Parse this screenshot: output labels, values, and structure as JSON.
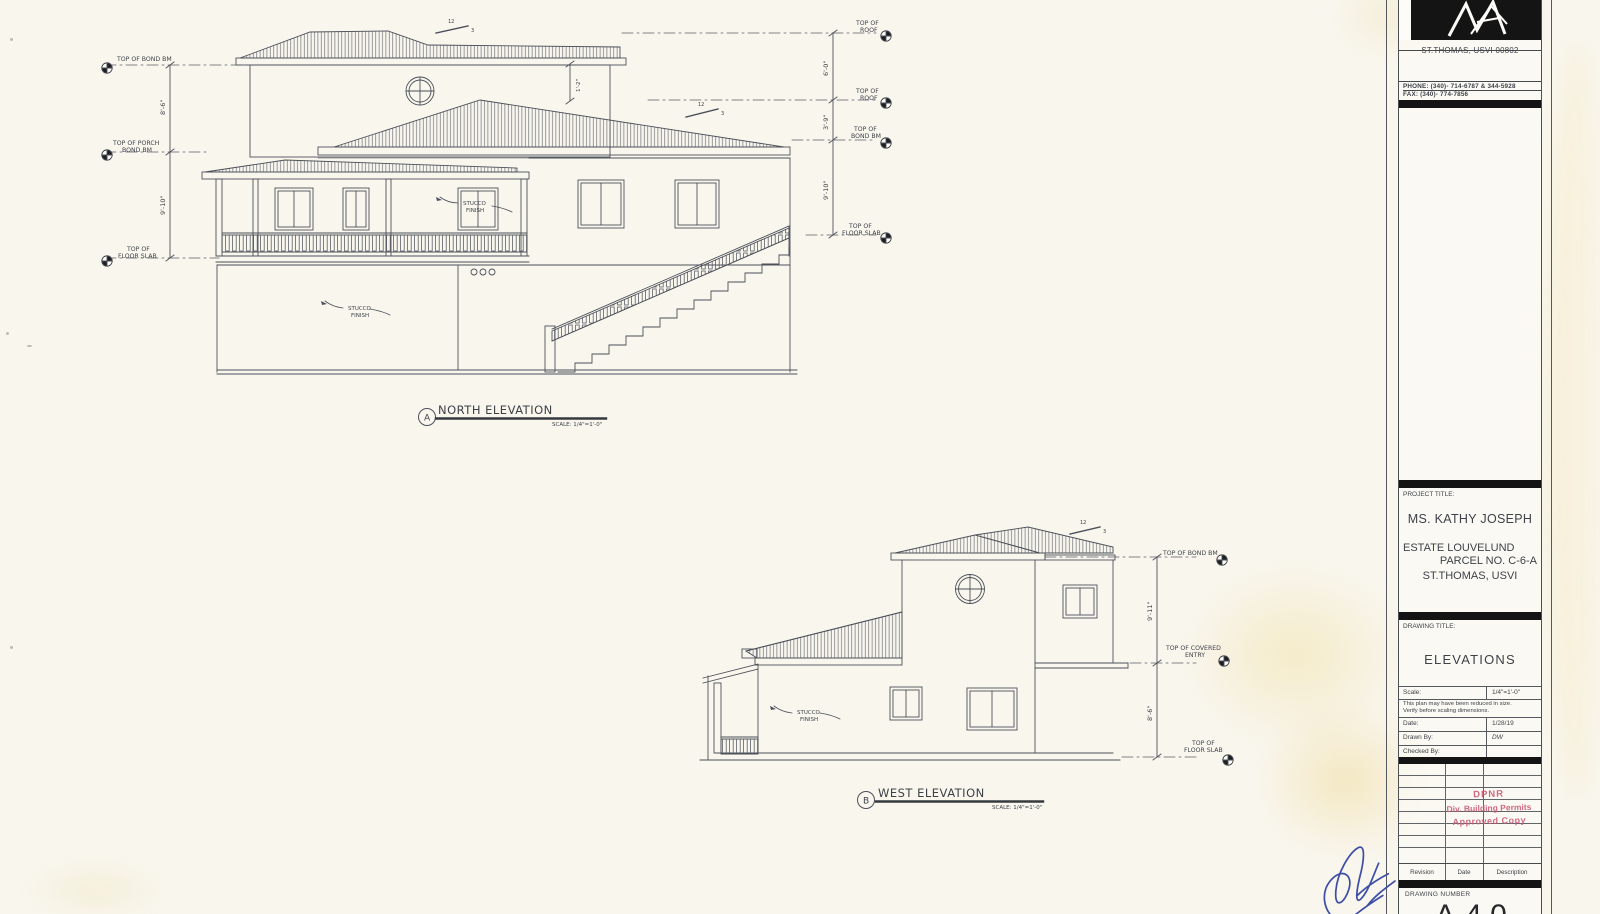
{
  "common": {
    "stucco_line1": "STUCCO",
    "stucco_line2": "FINISH"
  },
  "north": {
    "tag": "A",
    "title": "NORTH ELEVATION",
    "scale_note": "SCALE: 1/4\"=1'-0\"",
    "labels": {
      "left1": "TOP OF BOND BM",
      "left2a": "TOP OF PORCH",
      "left2b": "BOND BM",
      "left3a": "TOP OF",
      "left3b": "FLOOR SLAB",
      "right1a": "TOP OF",
      "right1b": "ROOF",
      "right2a": "TOP OF",
      "right2b": "ROOF",
      "right3a": "TOP OF",
      "right3b": "BOND BM",
      "right4a": "TOP OF",
      "right4b": "FLOOR SLAB"
    },
    "dims": {
      "left_upper": "8'-6\"",
      "left_lower": "9'-10\"",
      "right_upper": "6'-0\"",
      "right_mid": "3'-9\"",
      "right_lower": "9'-10\"",
      "ridge": "1'-2\""
    },
    "slope_rise": "12",
    "slope_run": "3"
  },
  "west": {
    "tag": "B",
    "title": "WEST ELEVATION",
    "scale_note": "SCALE: 1/4\"=1'-0\"",
    "labels": {
      "right1": "TOP OF BOND BM",
      "right2a": "TOP OF COVERED",
      "right2b": "ENTRY",
      "right3a": "TOP OF",
      "right3b": "FLOOR SLAB"
    },
    "dims": {
      "upper": "9'-11\"",
      "lower": "8'-6\""
    },
    "slope_rise": "12",
    "slope_run": "3"
  },
  "title_block": {
    "address": "ST.THOMAS, USVI 00802",
    "phone": "PHONE: (340)- 714-6787 & 344-5928",
    "fax": "FAX: (340)- 774-7856",
    "project_title_label": "PROJECT TITLE:",
    "client": "MS. KATHY JOSEPH",
    "estate": "ESTATE LOUVELUND",
    "parcel": "PARCEL NO. C-6-A",
    "location": "ST.THOMAS, USVI",
    "drawing_title_label": "DRAWING TITLE:",
    "drawing_title": "ELEVATIONS",
    "info": {
      "scale_label": "Scale:",
      "scale_value": "1/4\"=1'-0\"",
      "note1": "This plan may have been reduced in size.",
      "note2": "Verify before scaling dimensions.",
      "date_label": "Date:",
      "date_value": "1/28/19",
      "drawn_label": "Drawn By:",
      "drawn_value": "DW",
      "checked_label": "Checked By:",
      "checked_value": ""
    },
    "stamp": {
      "line1": "DPNR",
      "line2": "Div. Building Permits",
      "line3": "Approved Copy"
    },
    "rev_headers": [
      "Revision",
      "Date",
      "Description"
    ],
    "drawing_number_label": "DRAWING NUMBER",
    "drawing_number": "A-4.0"
  }
}
